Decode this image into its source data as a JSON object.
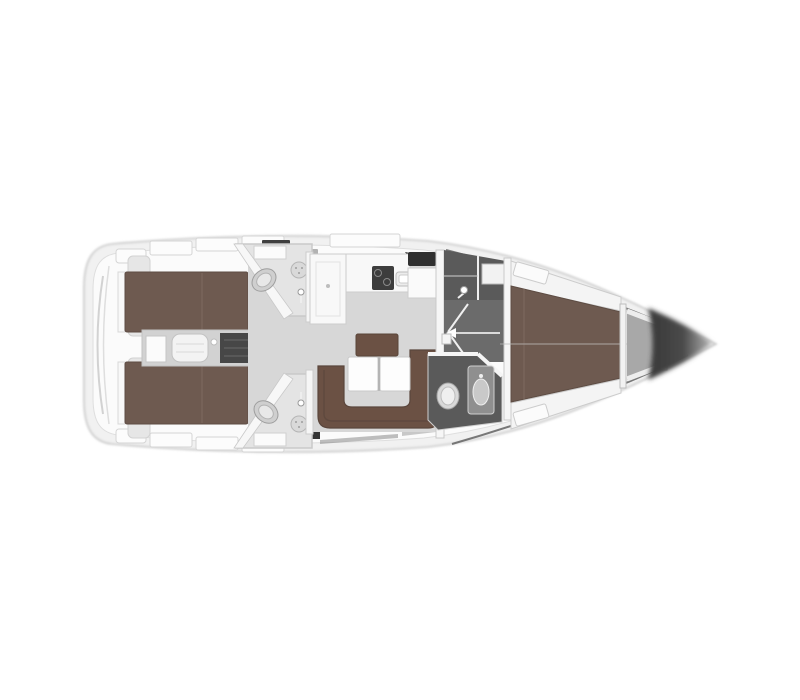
{
  "page": {
    "background": "#ffffff"
  },
  "diagram": {
    "type": "yacht-interior-floor-plan",
    "orientation": "stern-left-bow-right",
    "colors": {
      "hull_fill": "#f1f1f1",
      "hull_stroke": "#c6c6c6",
      "deck_fill": "#fbfbfb",
      "deck_stroke": "#dedede",
      "floor_gray": "#d7d7d7",
      "strip_gray": "#d2d2d2",
      "room_gray": "#e4e4e4",
      "dark_floor": "#5a5a5a",
      "corridor_gray": "#6b6b6b",
      "wood_brown": "#6e5a50",
      "sofa_brown": "#6b5144",
      "engine_dark": "#474747",
      "seat_dark": "#303030",
      "stove_dark": "#3d3d3d",
      "bow_dark": "#383838",
      "bow_light": "#b5b5b5",
      "white_furniture": "#fafafa",
      "fixture_gray": "#d6d6d6",
      "outline": "#c9c9c9"
    },
    "areas": [
      {
        "name": "swim-platform-stern"
      },
      {
        "name": "aft-cabin-upper-double-berth"
      },
      {
        "name": "aft-cabin-lower-double-berth"
      },
      {
        "name": "engine-room-and-companionway"
      },
      {
        "name": "aft-head-upper-with-shower"
      },
      {
        "name": "aft-head-lower-with-shower"
      },
      {
        "name": "galley-l-shaped"
      },
      {
        "name": "chart-table-nav-station"
      },
      {
        "name": "salon-u-shaped-settee"
      },
      {
        "name": "salon-folding-table"
      },
      {
        "name": "forward-shower-room"
      },
      {
        "name": "forward-passageway-door"
      },
      {
        "name": "forward-head-toilet-sink"
      },
      {
        "name": "forward-cabin-v-berth"
      },
      {
        "name": "anchor-locker"
      },
      {
        "name": "bow-tip"
      }
    ]
  }
}
